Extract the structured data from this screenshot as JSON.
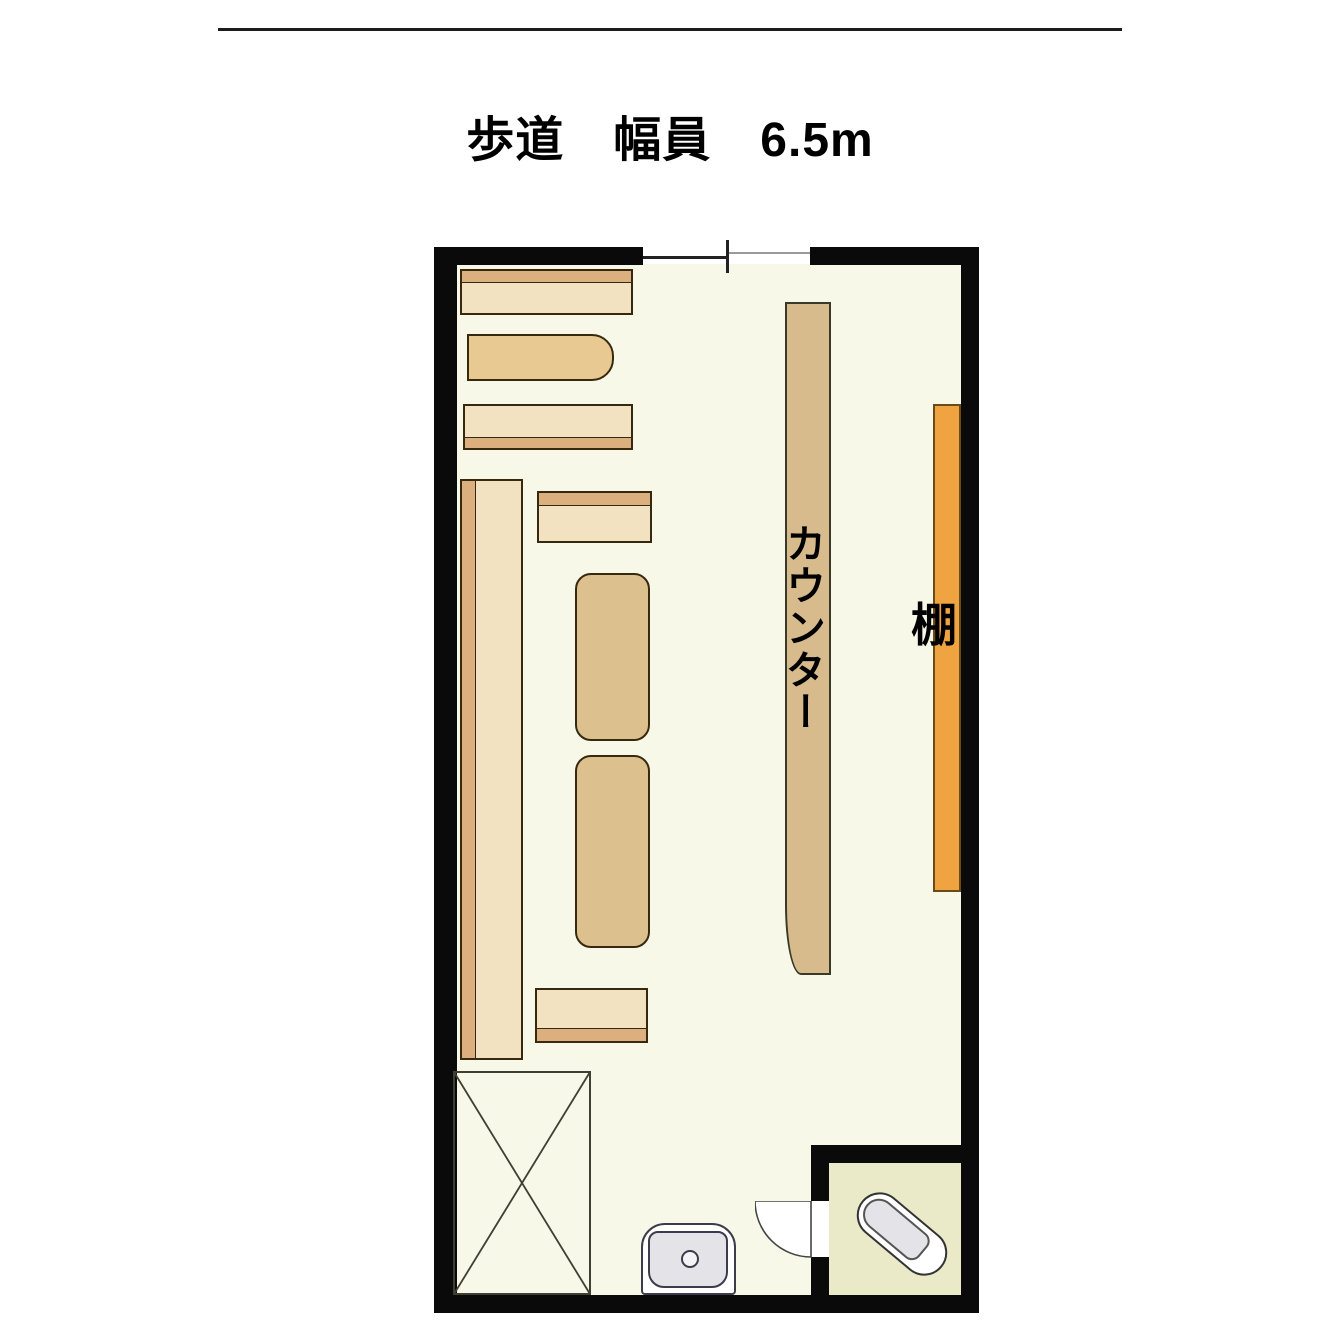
{
  "title": {
    "text": "歩道　幅員　6.5m"
  },
  "plan": {
    "labels": {
      "counter": "カウンター",
      "shelf": "棚"
    },
    "fixtures": [
      "counter",
      "wall-shelf",
      "display-shelves",
      "tables",
      "void-x-area",
      "toilet",
      "bathtub",
      "entrance-sliding-door",
      "bath-swing-door"
    ]
  },
  "colors": {
    "wall": "#0a0a0a",
    "rule": "#1c1c1c",
    "floor_main": "#f8f8e8",
    "floor_bath": "#eaeac8",
    "furniture_light": "#f2e2c1",
    "furniture_trim": "#dbaf7e",
    "furniture_rounded": "#e9c992",
    "furniture_tan": "#dcc08e",
    "counter": "#d7bb8c",
    "shelf_orange": "#f0a441",
    "fixture_gray": "#e4e4e8"
  }
}
